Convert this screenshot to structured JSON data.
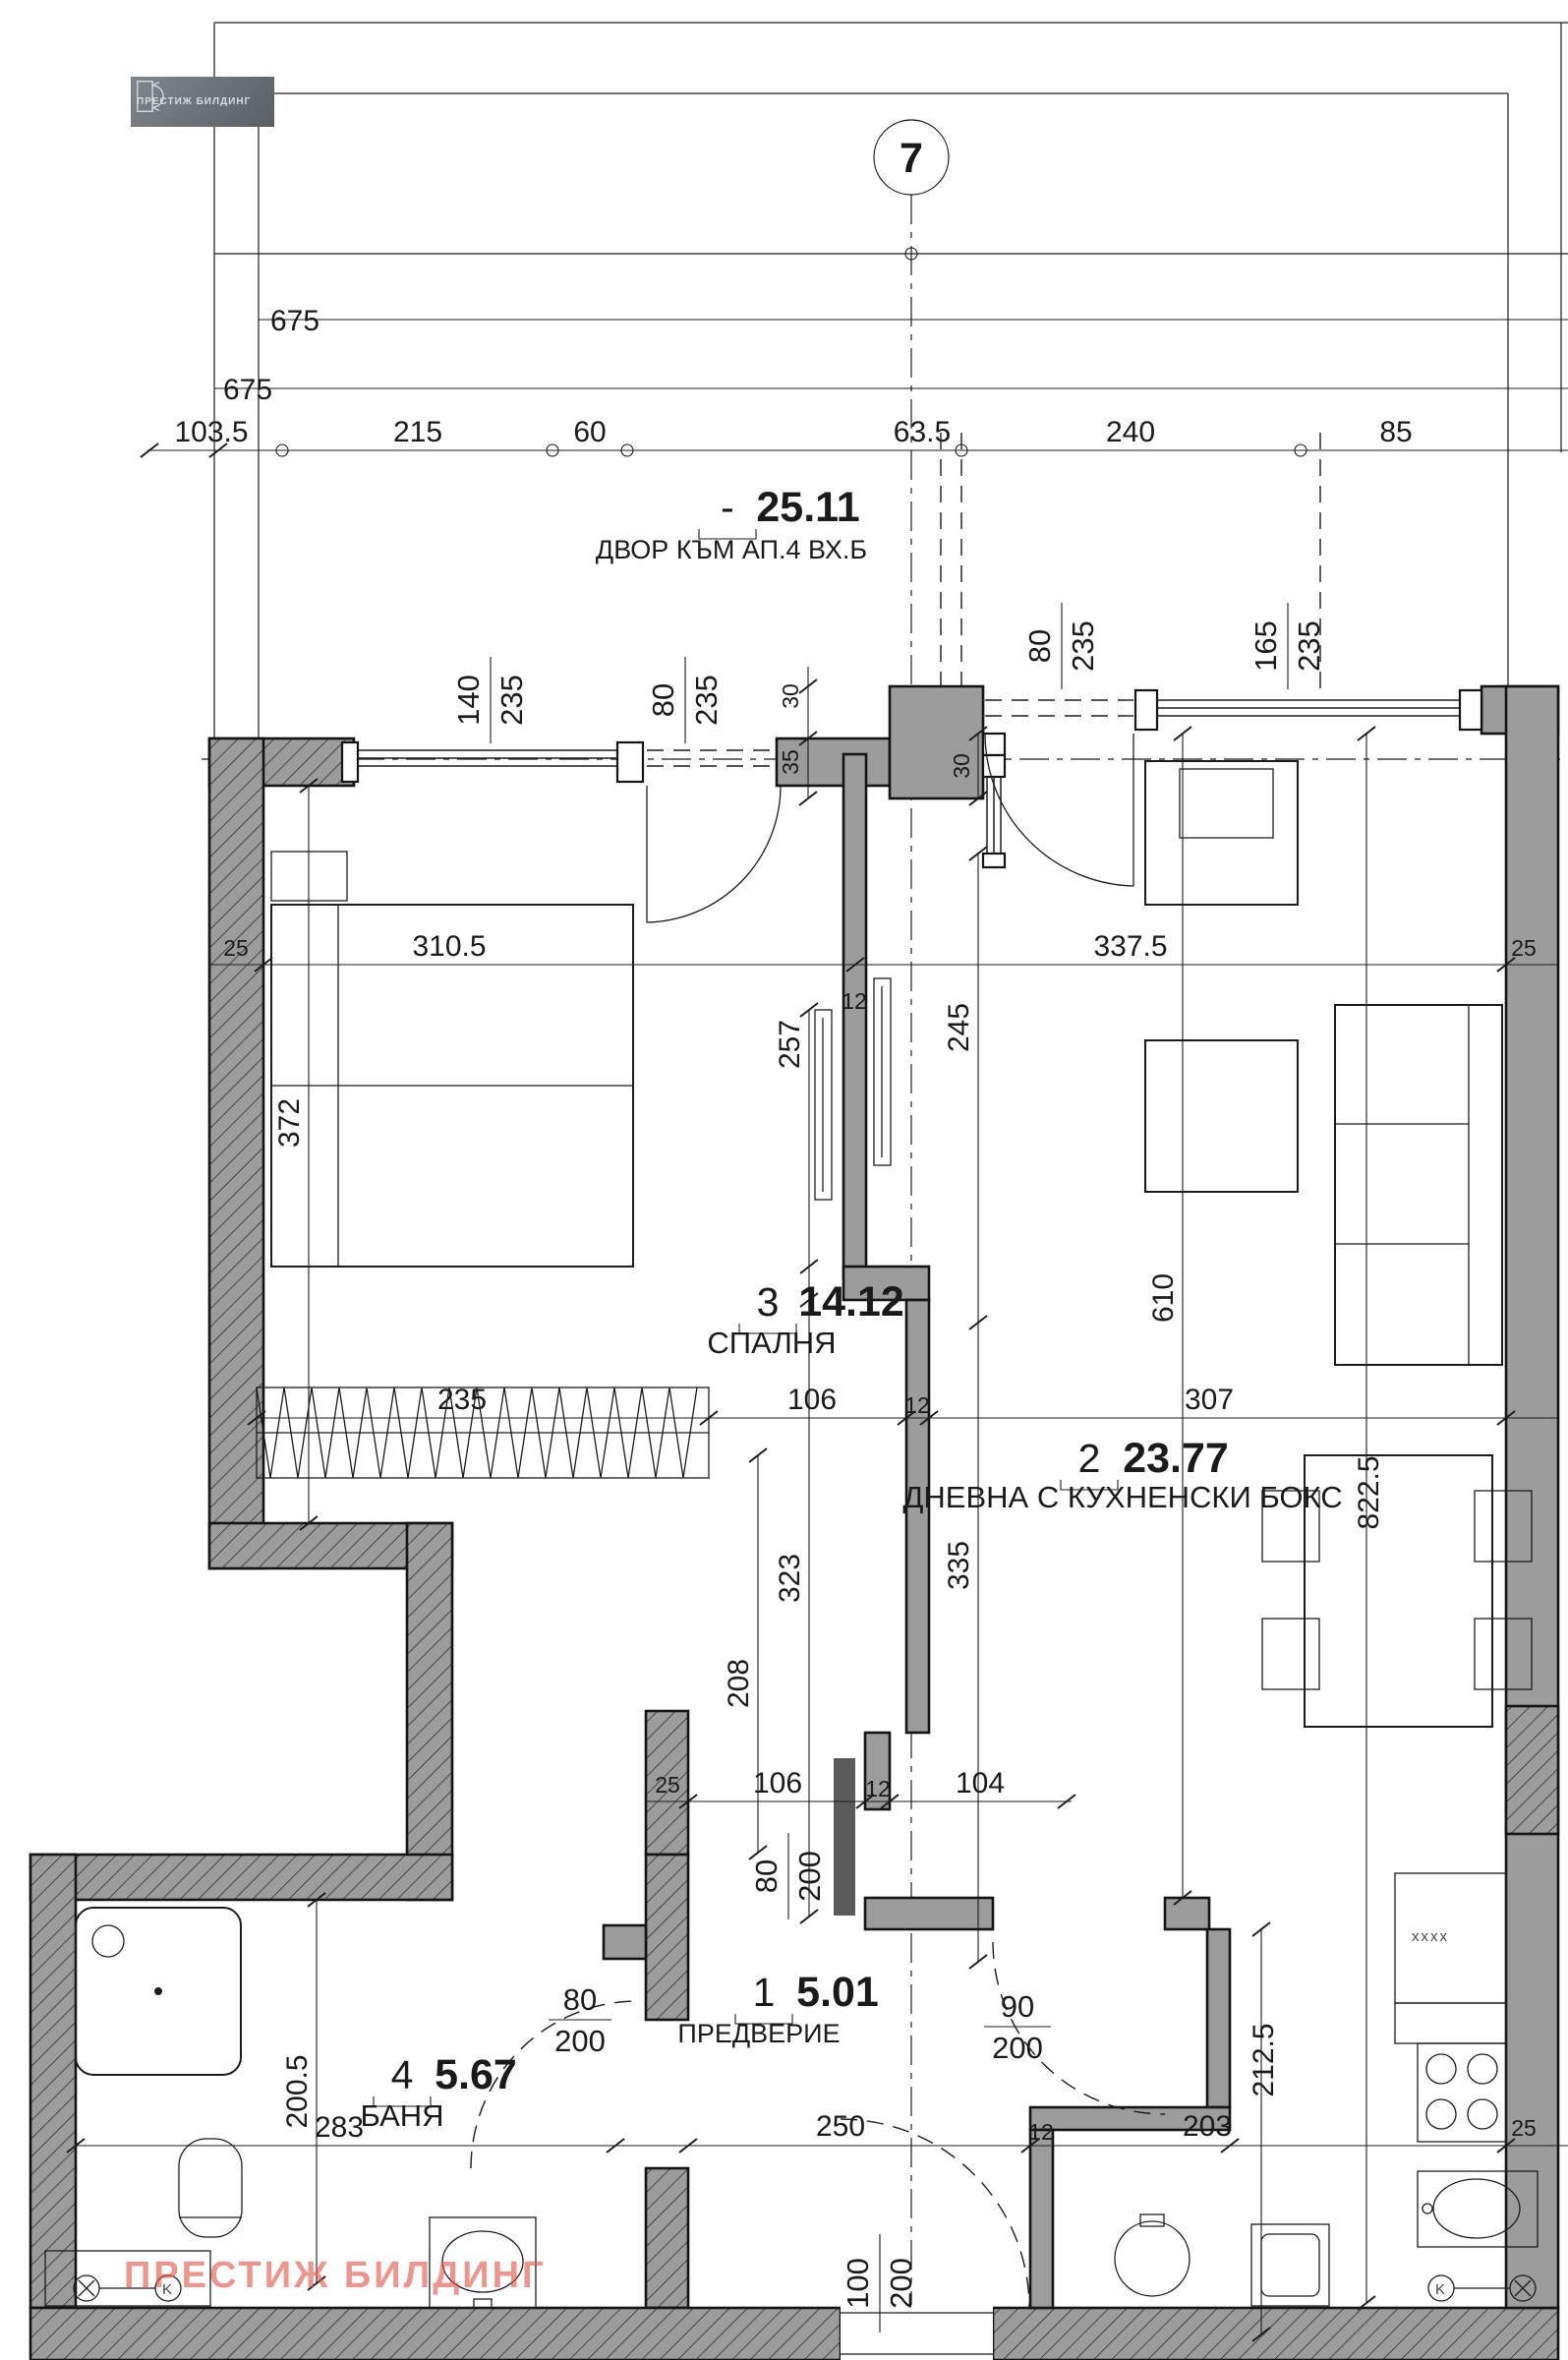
{
  "colors": {
    "wall_fill": "#9c9c9c",
    "line": "#1c1c1c",
    "watermark": "#e0564b",
    "logo_bg": "#70757c",
    "logo_fg": "#d9dbde"
  },
  "logo": {
    "text": "ПРЕСТИЖ БИЛДИНГ"
  },
  "watermark": {
    "text": "ПРЕСТИЖ БИЛДИНГ"
  },
  "axis": {
    "marker": "7"
  },
  "symbols": {
    "k": "K",
    "kitchen_mark": "xxxx"
  },
  "rooms": {
    "yard": {
      "num": "-",
      "area": "25.11",
      "name": "ДВОР КЪМ АП.4 ВХ.Б"
    },
    "hall": {
      "num": "1",
      "area": "5.01",
      "name": "ПРЕДВЕРИЕ"
    },
    "living": {
      "num": "2",
      "area": "23.77",
      "name": "ДНЕВНА С КУХНЕНСКИ БОКС"
    },
    "bedroom": {
      "num": "3",
      "area": "14.12",
      "name": "СПАЛНЯ"
    },
    "bath": {
      "num": "4",
      "area": "5.67",
      "name": "БАНЯ"
    }
  },
  "openings": {
    "bedroom_window": {
      "w": "140",
      "h": "235"
    },
    "bedroom_door": {
      "w": "80",
      "h": "235"
    },
    "living_door": {
      "w": "80",
      "h": "235"
    },
    "living_window": {
      "w": "165",
      "h": "235"
    },
    "bath_door": {
      "w": "80",
      "h": "200"
    },
    "living_int_door": {
      "w": "90",
      "h": "200"
    },
    "hall_slide_door": {
      "w": "80",
      "h": "200"
    },
    "entrance_door": {
      "w": "100",
      "h": "200"
    }
  },
  "dims": {
    "t675a": "675",
    "t675b": "675",
    "t103": "103.5",
    "t215": "215",
    "t60": "60",
    "t63": "63.5",
    "t240": "240",
    "t85": "85",
    "v372": "372",
    "v257": "257",
    "v245": "245",
    "v610": "610",
    "v822": "822.5",
    "v323": "323",
    "v335": "335",
    "v208": "208",
    "v200": "200.5",
    "v212": "212.5",
    "w25a": "25",
    "b310": "310.5",
    "b337": "337.5",
    "w25b": "25",
    "m235": "235",
    "m106": "106",
    "m307": "307",
    "h25": "25",
    "h106": "106",
    "h104": "104",
    "b283": "283",
    "b250": "250",
    "b203": "203",
    "w25c": "25",
    "t12a": "12",
    "t12b": "12",
    "t12c": "12",
    "t12d": "12",
    "s30a": "30",
    "s35": "35",
    "s30b": "30"
  }
}
